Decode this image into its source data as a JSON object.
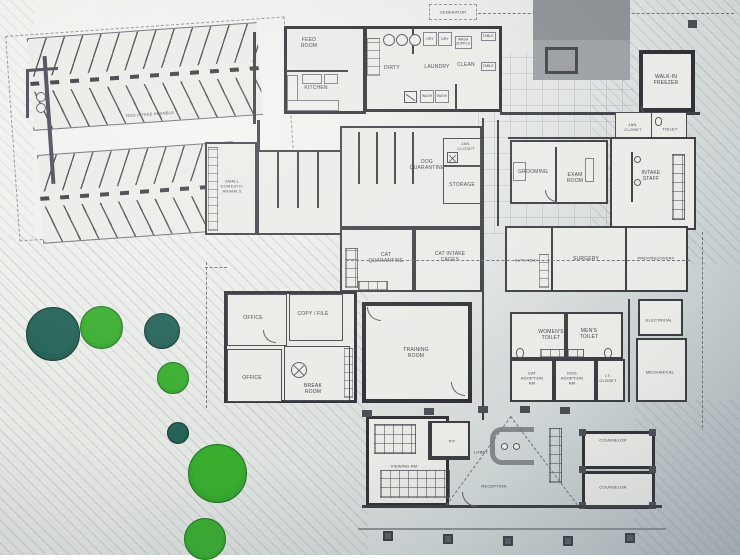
{
  "site": {
    "generator": "GENERATOR",
    "dog_intake_kennels": "DOG INTAKE KENNELS",
    "kennel_row_top_count": 12,
    "kennel_row_bottom_count": 8
  },
  "rooms": {
    "feed_room": "FEED\nROOM",
    "kitchen": "KITCHEN",
    "dirty": "DIRTY",
    "laundry": "LAUNDRY",
    "clean": "CLEAN",
    "walk_in_freezer": "WALK-IN\nFREEZER",
    "small_domestic_animals": "SMALL\nDOMESTIC\nANIMALS",
    "dog_quarantine": "DOG\nQUARANTINE",
    "jan_closet_1": "JAN.\nCLOSET",
    "storage": "STORAGE",
    "grooming": "GROOMING",
    "exam_room": "EXAM\nROOM",
    "jan_closet_2": "JAN.\nCLOSET",
    "toilet": "TOILET",
    "intake_staff": "INTAKE\nSTAFF",
    "cat_quarantine": "CAT\nQUARANTINE",
    "cat_intake_cages": "CAT INTAKE\nCAGES",
    "euth_med": "EUTH/MED",
    "surgery": "SURGERY",
    "prep_recovery": "PREP/RECOVERY",
    "office_1": "OFFICE",
    "copy_file": "COPY / FILE",
    "office_2": "OFFICE",
    "break_room": "BREAK\nROOM",
    "training_room": "TRAINING\nROOM",
    "womens_toilet": "WOMEN'S\nTOILET",
    "mens_toilet": "MEN'S\nTOILET",
    "cat_adoption": "CAT\nADOPTION\nRM",
    "dog_adoption": "DOG\nADOPTION\nRM",
    "it_closet": "I.T.\nCLOSET",
    "electrical": "ELECTRICAL",
    "mechanical": "MECHANICAL",
    "viewing_room": "VIEWING RM",
    "pit": "PIT",
    "lobby": "LOBBY",
    "reception": "RECEPTION",
    "counselor_1": "COUNSELOR",
    "counselor_2": "COUNSELOR"
  },
  "equipment": {
    "dry_1": "DRY",
    "dry_2": "DRY",
    "wash_supplies": "WASH\nSUPPLS",
    "wash_1": "WASH",
    "wash_2": "WASH",
    "table_1": "TABLE",
    "table_2": "TABLE"
  },
  "colors": {
    "tree_dark": "#1f5c51",
    "tree_bright": "#2fa42c",
    "paper": "#eaebe7",
    "wall_ink": "#34363b"
  }
}
